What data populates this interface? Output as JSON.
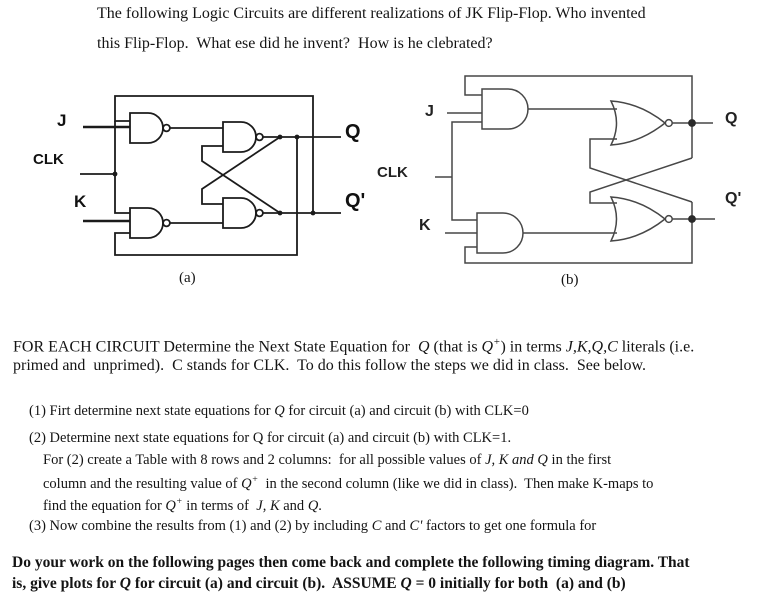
{
  "colors": {
    "background": "#ffffff",
    "text": "#141414",
    "circuit_a_stroke": "#1b1b1b",
    "circuit_b_stroke": "#474747"
  },
  "header": {
    "line1": [
      {
        "t": "The following Logic Circuits are different realizations of JK Flip-Flop. Who invented"
      }
    ],
    "line2": [
      {
        "t": "this Flip-Flop.  What ese did he invent?  How is he clebrated?"
      }
    ]
  },
  "circuit_a": {
    "caption": "(a)",
    "type": "NAND realization",
    "labels": {
      "j": "J",
      "clk": "CLK",
      "k": "K",
      "q": "Q",
      "q_prime": "Q'"
    }
  },
  "circuit_b": {
    "caption": "(b)",
    "type": "AND-NOR realization",
    "labels": {
      "j": "J",
      "clk": "CLK",
      "k": "K",
      "q": "Q",
      "q_prime": "Q'"
    }
  },
  "body": {
    "intro": {
      "line1": [
        {
          "t": "FOR EACH CIRCUIT Determine the Next State Equation for  "
        },
        {
          "t": "Q",
          "i": true
        },
        {
          "t": " (that is "
        },
        {
          "t": "Q",
          "i": true
        },
        {
          "t": "+",
          "i": true,
          "sup": true
        },
        {
          "t": ") in terms "
        },
        {
          "t": "J,K,Q,C",
          "i": true
        },
        {
          "t": " literals (i.e."
        }
      ],
      "line2": [
        {
          "t": "primed and  unprimed).  C stands for CLK.  To do this follow the steps we did in class.  See below."
        }
      ]
    },
    "steps": {
      "item1": [
        {
          "t": "(1) Firt determine next state equations for "
        },
        {
          "t": "Q",
          "i": true
        },
        {
          "t": " for circuit (a) and circuit (b) with CLK=0"
        }
      ],
      "item2_line1": [
        {
          "t": "(2) Determine next state equations for Q for circuit (a) and circuit (b) with CLK=1."
        }
      ],
      "item2_line2": [
        {
          "t": "For (2) create a Table with 8 rows and 2 columns:  for all possible values of "
        },
        {
          "t": "J, K and Q",
          "i": true
        },
        {
          "t": " in the first"
        }
      ],
      "item2_line3": [
        {
          "t": "column and the resulting value of "
        },
        {
          "t": "Q",
          "i": true
        },
        {
          "t": "+",
          "i": true,
          "sup": true
        },
        {
          "t": "  in the second column (like we did in class).  Then make K-maps to"
        }
      ],
      "item2_line4": [
        {
          "t": "find the equation for "
        },
        {
          "t": "Q",
          "i": true
        },
        {
          "t": "+",
          "i": true,
          "sup": true
        },
        {
          "t": " in terms of  "
        },
        {
          "t": "J, K",
          "i": true
        },
        {
          "t": " and "
        },
        {
          "t": "Q",
          "i": true
        },
        {
          "t": "."
        }
      ],
      "item3": [
        {
          "t": "(3) Now combine the results from (1) and (2) by including "
        },
        {
          "t": "C",
          "i": true
        },
        {
          "t": " and "
        },
        {
          "t": "C'",
          "i": true
        },
        {
          "t": " factors to get one formula for"
        }
      ]
    },
    "closing": {
      "line1": [
        {
          "t": "Do your work on the following pages then come back and complete the following timing diagram. That"
        }
      ],
      "line2": [
        {
          "t": "is, give plots for "
        },
        {
          "t": "Q",
          "i": true
        },
        {
          "t": " for circuit (a) and circuit (b).  ASSUME "
        },
        {
          "t": "Q",
          "i": true
        },
        {
          "t": " = 0 initially for both  (a) and (b)"
        }
      ]
    }
  }
}
